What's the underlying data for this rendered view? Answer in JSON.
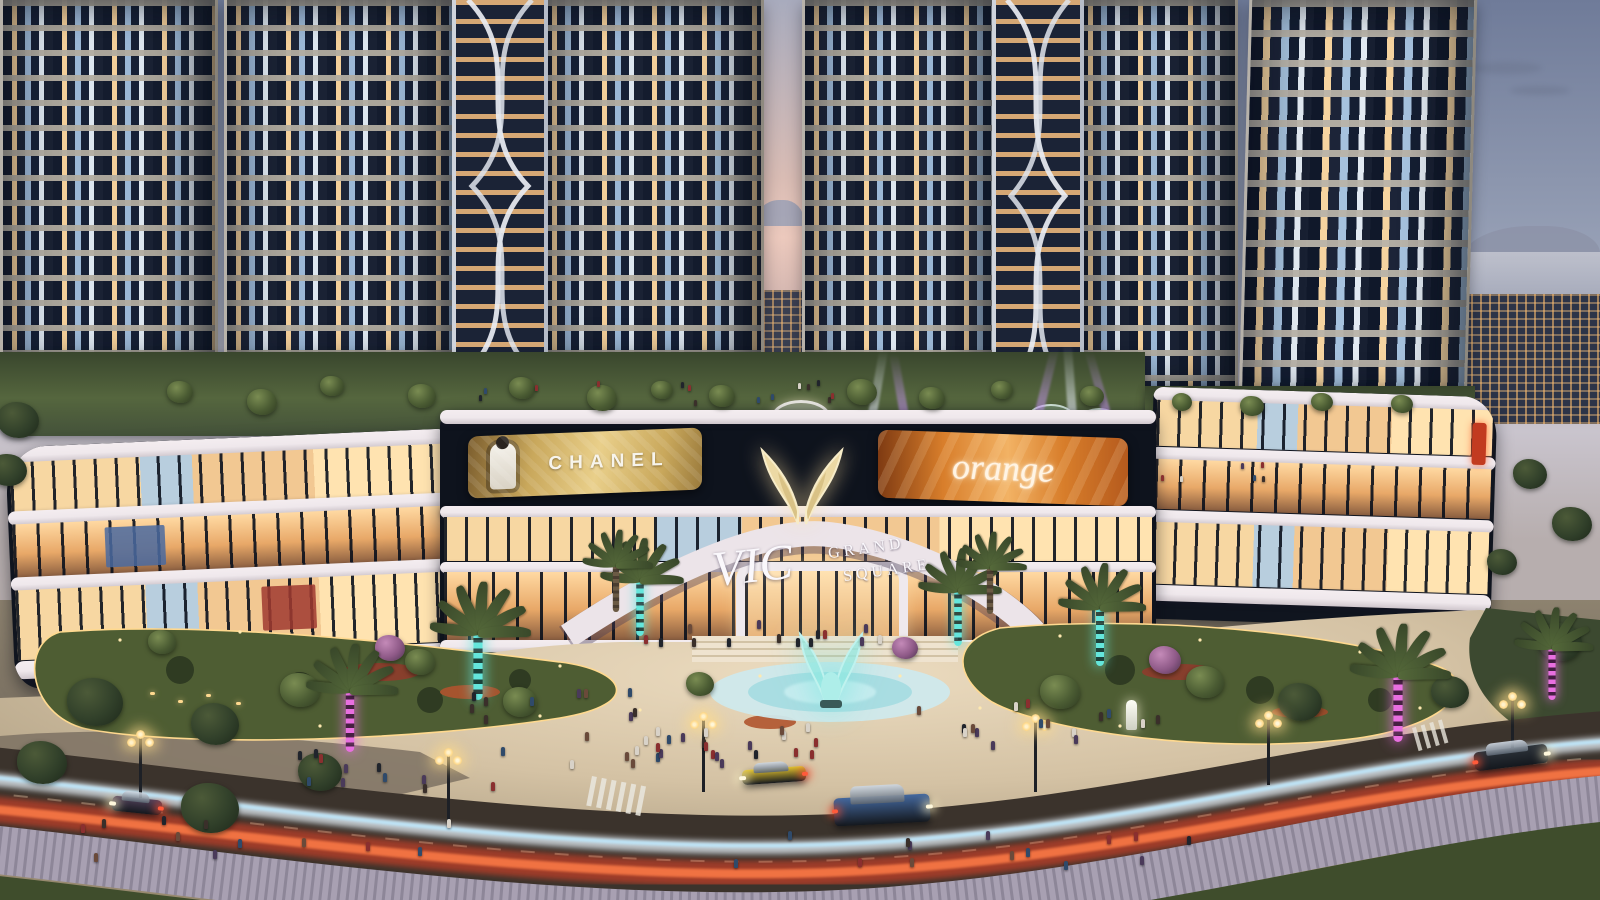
{
  "scene": {
    "name": "VIC Grand Square",
    "description": "Twilight rendering of the VIC Grand Square complex: residential towers above an illuminated curved shopping-mall podium, rooftop amenity garden, plaza with glowing winged fountain statue, LED-wrapped palm trees and a boulevard with car light trails."
  },
  "signage": {
    "chanel": "CHANEL",
    "led_screen": "orange",
    "logo_vic": "VIC",
    "logo_grand": "GRAND",
    "logo_square": "SQUARE"
  },
  "colors": {
    "sky-top": "#6f7b99",
    "sky-mid": "#9aa3b8",
    "sky-low": "#c9c4cd",
    "sunset": "#ecc9bd",
    "gold-1": "#c9a85c",
    "gold-2": "#e9cf8a",
    "orange-1": "#d87e2b",
    "orange-2": "#b55a1d",
    "teal": "#64e6dc",
    "magenta": "#e86fe0",
    "trail-red": "#ff4526",
    "trail-white": "#e8f3fb",
    "pool": "#cfe9ec",
    "statue": "#8fe3de",
    "slab": "#efe8ec",
    "glass-warm": "#ffd9a2",
    "glass-deep": "#10151f",
    "pav": "#e0cfb2",
    "grass": "#4c5a35",
    "road": "#3b332c"
  },
  "vehicles": [
    {
      "type": "sports-car",
      "color": "#e3c32f",
      "x": 742,
      "y": 768,
      "w": 64,
      "h": 15,
      "r": -4,
      "dir": "left"
    },
    {
      "type": "suv",
      "color": "#44689e",
      "x": 834,
      "y": 796,
      "w": 96,
      "h": 28,
      "r": -3,
      "dir": "right"
    },
    {
      "type": "sedan",
      "color": "#2e343b",
      "x": 1474,
      "y": 748,
      "w": 74,
      "h": 19,
      "r": -7,
      "dir": "right"
    },
    {
      "type": "hatchback",
      "color": "#52415a",
      "x": 112,
      "y": 798,
      "w": 50,
      "h": 15,
      "r": 6,
      "dir": "left"
    }
  ],
  "street_lamps": [
    {
      "x": 140,
      "y": 798,
      "h": 66
    },
    {
      "x": 448,
      "y": 822,
      "h": 72
    },
    {
      "x": 703,
      "y": 792,
      "h": 78
    },
    {
      "x": 1035,
      "y": 792,
      "h": 76
    },
    {
      "x": 1268,
      "y": 785,
      "h": 72
    },
    {
      "x": 1512,
      "y": 754,
      "h": 60
    }
  ],
  "palm_trees": [
    {
      "x": 478,
      "y": 700,
      "s": 1.15,
      "glow": "teal"
    },
    {
      "x": 640,
      "y": 636,
      "s": 0.95,
      "glow": "teal"
    },
    {
      "x": 958,
      "y": 646,
      "s": 0.95,
      "glow": "teal"
    },
    {
      "x": 1100,
      "y": 666,
      "s": 1.0,
      "glow": "teal"
    },
    {
      "x": 350,
      "y": 752,
      "s": 1.05,
      "glow": "magenta"
    },
    {
      "x": 1398,
      "y": 742,
      "s": 1.15,
      "glow": "magenta"
    },
    {
      "x": 1552,
      "y": 700,
      "s": 0.9,
      "glow": "magenta"
    },
    {
      "x": 616,
      "y": 612,
      "s": 0.8,
      "glow": "plain"
    },
    {
      "x": 990,
      "y": 614,
      "s": 0.8,
      "glow": "plain"
    }
  ],
  "trees": [
    {
      "x": 180,
      "y": 392,
      "s": 26,
      "c": "green"
    },
    {
      "x": 262,
      "y": 402,
      "s": 30,
      "c": "green"
    },
    {
      "x": 332,
      "y": 386,
      "s": 24,
      "c": "green"
    },
    {
      "x": 422,
      "y": 396,
      "s": 28,
      "c": "green"
    },
    {
      "x": 522,
      "y": 388,
      "s": 26,
      "c": "green"
    },
    {
      "x": 602,
      "y": 398,
      "s": 30,
      "c": "green"
    },
    {
      "x": 662,
      "y": 390,
      "s": 22,
      "c": "green"
    },
    {
      "x": 722,
      "y": 396,
      "s": 26,
      "c": "green"
    },
    {
      "x": 862,
      "y": 392,
      "s": 30,
      "c": "green"
    },
    {
      "x": 932,
      "y": 398,
      "s": 26,
      "c": "green"
    },
    {
      "x": 1002,
      "y": 390,
      "s": 22,
      "c": "green"
    },
    {
      "x": 1092,
      "y": 396,
      "s": 24,
      "c": "green"
    },
    {
      "x": 1182,
      "y": 402,
      "s": 20,
      "c": "green"
    },
    {
      "x": 1252,
      "y": 406,
      "s": 24,
      "c": "green"
    },
    {
      "x": 1322,
      "y": 402,
      "s": 22,
      "c": "green"
    },
    {
      "x": 1402,
      "y": 404,
      "s": 22,
      "c": "green"
    },
    {
      "x": 95,
      "y": 702,
      "s": 56,
      "c": "dark"
    },
    {
      "x": 215,
      "y": 724,
      "s": 48,
      "c": "dark"
    },
    {
      "x": 300,
      "y": 690,
      "s": 40,
      "c": "green"
    },
    {
      "x": 520,
      "y": 702,
      "s": 34,
      "c": "green"
    },
    {
      "x": 700,
      "y": 684,
      "s": 28,
      "c": "green"
    },
    {
      "x": 1060,
      "y": 692,
      "s": 40,
      "c": "green"
    },
    {
      "x": 1205,
      "y": 682,
      "s": 38,
      "c": "green"
    },
    {
      "x": 1300,
      "y": 702,
      "s": 44,
      "c": "dark"
    },
    {
      "x": 1450,
      "y": 692,
      "s": 38,
      "c": "dark"
    },
    {
      "x": 162,
      "y": 642,
      "s": 28,
      "c": "green"
    },
    {
      "x": 420,
      "y": 662,
      "s": 30,
      "c": "green"
    },
    {
      "x": 390,
      "y": 648,
      "s": 30,
      "c": "purple"
    },
    {
      "x": 905,
      "y": 648,
      "s": 26,
      "c": "purple"
    },
    {
      "x": 1165,
      "y": 660,
      "s": 32,
      "c": "purple"
    },
    {
      "x": 210,
      "y": 808,
      "s": 58,
      "c": "dark"
    },
    {
      "x": 320,
      "y": 772,
      "s": 44,
      "c": "dark"
    },
    {
      "x": 42,
      "y": 762,
      "s": 50,
      "c": "dark"
    },
    {
      "x": 1530,
      "y": 474,
      "s": 34,
      "c": "dark"
    },
    {
      "x": 1572,
      "y": 524,
      "s": 40,
      "c": "dark"
    },
    {
      "x": 1502,
      "y": 562,
      "s": 30,
      "c": "dark"
    },
    {
      "x": 1560,
      "y": 642,
      "s": 44,
      "c": "dark"
    },
    {
      "x": 18,
      "y": 420,
      "s": 42,
      "c": "dark"
    },
    {
      "x": 8,
      "y": 470,
      "s": 38,
      "c": "dark"
    }
  ],
  "people_clusters": [
    {
      "x": 700,
      "y": 742,
      "w": 260,
      "h": 42,
      "n": 26
    },
    {
      "x": 560,
      "y": 700,
      "w": 180,
      "h": 30,
      "n": 10
    },
    {
      "x": 760,
      "y": 630,
      "w": 260,
      "h": 20,
      "n": 14
    },
    {
      "x": 1040,
      "y": 716,
      "w": 260,
      "h": 52,
      "n": 16
    },
    {
      "x": 400,
      "y": 766,
      "w": 220,
      "h": 40,
      "n": 12
    },
    {
      "x": 240,
      "y": 836,
      "w": 420,
      "h": 40,
      "n": 12
    },
    {
      "x": 940,
      "y": 842,
      "w": 520,
      "h": 42,
      "n": 14
    },
    {
      "x": 640,
      "y": 392,
      "w": 420,
      "h": 24,
      "n": 14
    },
    {
      "x": 1180,
      "y": 470,
      "w": 200,
      "h": 18,
      "n": 6
    }
  ]
}
